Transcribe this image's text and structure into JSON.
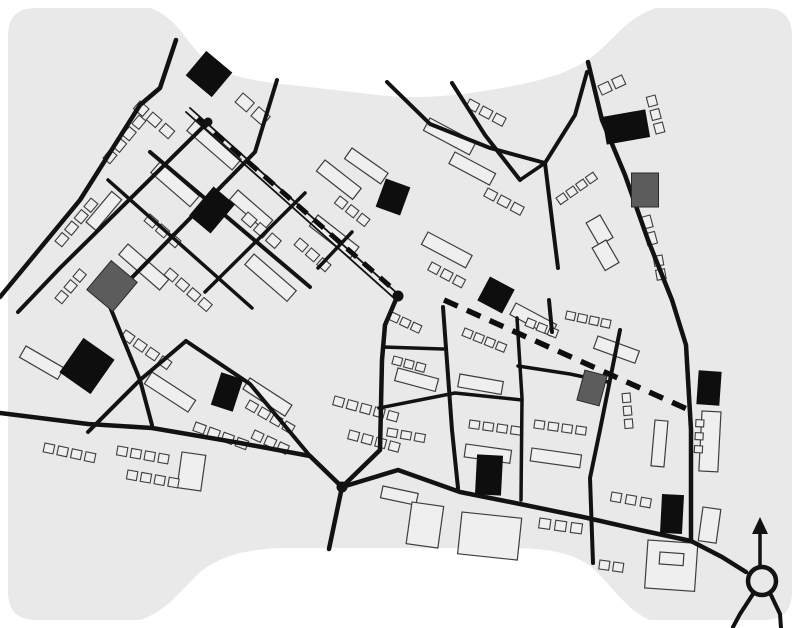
{
  "meta": {
    "figure_kind": "figure-ground urban plan map",
    "canvas": {
      "w": 800,
      "h": 628
    }
  },
  "palette": {
    "page_bg": "#ffffff",
    "map_bg": "#e9e9e9",
    "road": "#121212",
    "building_stroke": "#3d3d3d",
    "building_fill": "#efefef",
    "landmark_fill": "#0e0e0e",
    "gray_fill": "#5c5c5c",
    "route_dash": "#0e0e0e"
  },
  "map_shape": "M 35 8 L 150 8 C 175 16 185 40 205 60 C 225 78 262 82 300 86 L 378 95 C 420 100 462 95 502 88 C 534 82 562 76 586 61 C 612 44 624 18 656 8 L 764 8 Q 792 8 792 36 L 792 592 Q 792 620 764 620 L 650 620 C 630 612 616 592 597 572 C 577 552 548 549 516 548 L 282 548 C 248 549 216 556 196 576 C 179 593 165 612 140 620 L 36 620 Q 8 620 8 592 L 8 36 Q 8 8 35 8 Z",
  "roads": [
    {
      "name": "nw-boundary-road",
      "w": 4.5,
      "pts": [
        [
          0,
          297
        ],
        [
          80,
          200
        ],
        [
          140,
          105
        ],
        [
          160,
          88
        ],
        [
          176,
          40
        ]
      ]
    },
    {
      "name": "cross-street-c1",
      "w": 4.0,
      "pts": [
        [
          208,
          122
        ],
        [
          60,
          268
        ],
        [
          18,
          312
        ]
      ]
    },
    {
      "name": "cross-street-c2",
      "w": 4.0,
      "pts": [
        [
          277,
          80
        ],
        [
          255,
          152
        ],
        [
          108,
          302
        ],
        [
          140,
          380
        ],
        [
          152,
          425
        ]
      ]
    },
    {
      "name": "cross-street-c3",
      "w": 3.5,
      "pts": [
        [
          305,
          193
        ],
        [
          205,
          292
        ]
      ]
    },
    {
      "name": "cross-street-c4",
      "w": 3.5,
      "pts": [
        [
          352,
          232
        ],
        [
          318,
          268
        ]
      ]
    },
    {
      "name": "parallel-street-s1",
      "w": 4.0,
      "pts": [
        [
          150,
          152
        ],
        [
          310,
          287
        ]
      ]
    },
    {
      "name": "parallel-street-s2",
      "w": 3.5,
      "pts": [
        [
          108,
          180
        ],
        [
          252,
          308
        ]
      ]
    },
    {
      "name": "sw-branch-street",
      "w": 4.0,
      "pts": [
        [
          186,
          341
        ],
        [
          140,
          380
        ],
        [
          88,
          432
        ]
      ]
    },
    {
      "name": "sw-diagonal-street",
      "w": 4.0,
      "pts": [
        [
          186,
          341
        ],
        [
          250,
          384
        ],
        [
          310,
          456
        ]
      ]
    },
    {
      "name": "southern-road",
      "w": 4.5,
      "pts": [
        [
          0,
          413
        ],
        [
          88,
          424
        ],
        [
          152,
          428
        ],
        [
          240,
          443
        ],
        [
          310,
          456
        ],
        [
          342,
          487
        ],
        [
          398,
          470
        ],
        [
          460,
          492
        ],
        [
          520,
          504
        ],
        [
          583,
          517
        ],
        [
          640,
          530
        ],
        [
          691,
          541
        ],
        [
          722,
          557
        ],
        [
          746,
          572
        ]
      ]
    },
    {
      "name": "central-vertical-v1",
      "w": 4.5,
      "pts": [
        [
          397,
          297
        ],
        [
          385,
          325
        ],
        [
          382,
          360
        ],
        [
          380,
          450
        ],
        [
          342,
          487
        ],
        [
          329,
          549
        ]
      ]
    },
    {
      "name": "central-vertical-v2",
      "w": 4.0,
      "pts": [
        [
          443,
          307
        ],
        [
          452,
          430
        ],
        [
          458,
          488
        ]
      ]
    },
    {
      "name": "central-vertical-v3",
      "w": 3.5,
      "pts": [
        [
          517,
          318
        ],
        [
          522,
          398
        ],
        [
          521,
          500
        ]
      ]
    },
    {
      "name": "central-stub-v3b",
      "w": 4.0,
      "pts": [
        [
          549,
          300
        ],
        [
          552,
          332
        ]
      ]
    },
    {
      "name": "central-vertical-v4",
      "w": 4.0,
      "pts": [
        [
          620,
          330
        ],
        [
          600,
          430
        ],
        [
          590,
          478
        ],
        [
          593,
          563
        ]
      ]
    },
    {
      "name": "central-horizontal-h1",
      "w": 3.5,
      "pts": [
        [
          379,
          408
        ],
        [
          455,
          393
        ],
        [
          522,
          400
        ]
      ]
    },
    {
      "name": "central-horizontal-h2",
      "w": 3.5,
      "pts": [
        [
          383,
          347
        ],
        [
          443,
          349
        ]
      ]
    },
    {
      "name": "central-horizontal-h3",
      "w": 3.5,
      "pts": [
        [
          518,
          366
        ],
        [
          570,
          374
        ],
        [
          608,
          382
        ]
      ]
    },
    {
      "name": "north-street-t1",
      "w": 4.0,
      "pts": [
        [
          387,
          82
        ],
        [
          430,
          124
        ],
        [
          490,
          148
        ],
        [
          545,
          163
        ]
      ]
    },
    {
      "name": "north-street-t2",
      "w": 4.0,
      "pts": [
        [
          452,
          83
        ],
        [
          485,
          135
        ],
        [
          520,
          180
        ]
      ]
    },
    {
      "name": "north-street-t2b",
      "w": 3.5,
      "pts": [
        [
          520,
          180
        ],
        [
          545,
          163
        ]
      ]
    },
    {
      "name": "north-street-t4",
      "w": 4.0,
      "pts": [
        [
          545,
          163
        ],
        [
          552,
          220
        ],
        [
          558,
          268
        ]
      ]
    },
    {
      "name": "north-street-r2",
      "w": 4.0,
      "pts": [
        [
          545,
          163
        ],
        [
          575,
          115
        ],
        [
          587,
          72
        ]
      ]
    },
    {
      "name": "east-boundary-road",
      "w": 4.5,
      "pts": [
        [
          588,
          62
        ],
        [
          602,
          120
        ],
        [
          625,
          175
        ],
        [
          648,
          240
        ],
        [
          672,
          300
        ],
        [
          686,
          345
        ],
        [
          691,
          430
        ],
        [
          691,
          540
        ]
      ]
    }
  ],
  "avenue": {
    "name": "main-avenue-double-line",
    "w": 1.8,
    "lines": [
      [
        [
          186,
          112
        ],
        [
          395,
          299
        ]
      ],
      [
        [
          190,
          108
        ],
        [
          399,
          295
        ]
      ]
    ]
  },
  "routes": [
    {
      "name": "dashed-route-nw",
      "w": 5.0,
      "dash": "13 9",
      "pts": [
        [
          198,
          118
        ],
        [
          392,
          288
        ]
      ]
    },
    {
      "name": "dashed-route-east",
      "w": 5.5,
      "dash": "15 10",
      "pts": [
        [
          444,
          300
        ],
        [
          687,
          409
        ]
      ]
    }
  ],
  "junction_dots": [
    {
      "x": 208,
      "y": 122,
      "r": 4.5
    },
    {
      "x": 398,
      "y": 296,
      "r": 5.5
    },
    {
      "x": 342,
      "y": 487,
      "r": 5.5
    }
  ],
  "roundabout": {
    "cx": 762,
    "cy": 581,
    "r": 14,
    "ring_w": 4.5,
    "arrow_stem": [
      [
        760,
        566
      ],
      [
        760,
        532
      ]
    ],
    "arrow_head": "760,517 752,534 768,534",
    "legs": [
      [
        [
          753,
          594
        ],
        [
          740,
          614
        ],
        [
          733,
          627
        ]
      ],
      [
        [
          771,
          595
        ],
        [
          780,
          614
        ],
        [
          781,
          628
        ]
      ]
    ]
  },
  "landmark_buildings": [
    [
      209,
      74,
      34,
      32,
      40
    ],
    [
      393,
      197,
      26,
      30,
      20
    ],
    [
      212,
      210,
      28,
      38,
      40
    ],
    [
      626,
      127,
      44,
      28,
      -10
    ],
    [
      87,
      366,
      38,
      42,
      35
    ],
    [
      227,
      392,
      23,
      34,
      18
    ],
    [
      496,
      295,
      28,
      27,
      28
    ],
    [
      709,
      388,
      23,
      34,
      4
    ],
    [
      489,
      475,
      26,
      40,
      3
    ],
    [
      672,
      514,
      22,
      39,
      3
    ]
  ],
  "gray_buildings": [
    [
      112,
      286,
      34,
      38,
      40
    ],
    [
      645,
      190,
      27,
      34,
      0
    ],
    [
      592,
      388,
      23,
      31,
      15
    ]
  ],
  "building_slabs": [
    [
      196,
      120,
      60,
      14,
      41
    ],
    [
      160,
      162,
      52,
      14,
      41
    ],
    [
      238,
      190,
      46,
      13,
      41
    ],
    [
      128,
      244,
      54,
      14,
      41
    ],
    [
      86,
      222,
      40,
      13,
      -50
    ],
    [
      254,
      254,
      56,
      14,
      41
    ],
    [
      325,
      160,
      46,
      14,
      38
    ],
    [
      318,
      215,
      52,
      14,
      38
    ],
    [
      430,
      118,
      52,
      14,
      28
    ],
    [
      455,
      152,
      46,
      13,
      28
    ],
    [
      352,
      148,
      44,
      13,
      35
    ],
    [
      428,
      232,
      50,
      14,
      28
    ],
    [
      516,
      303,
      46,
      13,
      28
    ],
    [
      398,
      368,
      42,
      13,
      15
    ],
    [
      460,
      374,
      44,
      13,
      10
    ],
    [
      466,
      444,
      46,
      13,
      8
    ],
    [
      532,
      448,
      50,
      13,
      8
    ],
    [
      598,
      336,
      44,
      13,
      20
    ],
    [
      655,
      420,
      13,
      46,
      5
    ],
    [
      702,
      411,
      19,
      60,
      3
    ],
    [
      703,
      507,
      18,
      34,
      8
    ],
    [
      26,
      346,
      44,
      13,
      30
    ],
    [
      152,
      372,
      52,
      14,
      33
    ],
    [
      250,
      378,
      50,
      13,
      33
    ],
    [
      182,
      452,
      24,
      36,
      8
    ],
    [
      383,
      486,
      36,
      12,
      12
    ],
    [
      412,
      502,
      32,
      42,
      8
    ],
    [
      462,
      512,
      60,
      42,
      6
    ],
    [
      648,
      540,
      50,
      48,
      4
    ],
    [
      660,
      552,
      24,
      12,
      4
    ],
    [
      600,
      215,
      26,
      16,
      60
    ],
    [
      606,
      240,
      26,
      16,
      60
    ]
  ],
  "building_rows": [
    [
      140,
      101,
      3,
      12,
      10,
      5,
      41
    ],
    [
      243,
      93,
      2,
      15,
      12,
      6,
      41
    ],
    [
      103,
      158,
      4,
      11,
      9,
      4,
      -50
    ],
    [
      55,
      241,
      4,
      11,
      9,
      4,
      -50
    ],
    [
      55,
      298,
      3,
      10,
      9,
      4,
      -50
    ],
    [
      248,
      212,
      3,
      12,
      10,
      4,
      41
    ],
    [
      150,
      214,
      3,
      11,
      9,
      4,
      41
    ],
    [
      170,
      268,
      4,
      11,
      9,
      4,
      41
    ],
    [
      300,
      238,
      3,
      11,
      9,
      4,
      41
    ],
    [
      340,
      196,
      3,
      10,
      9,
      4,
      38
    ],
    [
      470,
      99,
      3,
      11,
      9,
      4,
      28
    ],
    [
      488,
      188,
      3,
      11,
      9,
      4,
      28
    ],
    [
      598,
      86,
      2,
      11,
      10,
      4,
      -25
    ],
    [
      556,
      198,
      4,
      9,
      8,
      3,
      -35
    ],
    [
      567,
      311,
      4,
      9,
      8,
      3,
      12
    ],
    [
      432,
      262,
      3,
      10,
      9,
      4,
      28
    ],
    [
      392,
      312,
      3,
      9,
      8,
      3,
      25
    ],
    [
      394,
      356,
      3,
      9,
      8,
      3,
      15
    ],
    [
      465,
      328,
      4,
      9,
      8,
      3,
      22
    ],
    [
      528,
      318,
      3,
      9,
      8,
      3,
      22
    ],
    [
      388,
      428,
      3,
      10,
      8,
      4,
      10
    ],
    [
      470,
      420,
      4,
      10,
      8,
      4,
      8
    ],
    [
      535,
      420,
      4,
      10,
      8,
      4,
      8
    ],
    [
      655,
      95,
      3,
      10,
      9,
      4,
      75
    ],
    [
      650,
      215,
      2,
      12,
      10,
      5,
      75
    ],
    [
      662,
      255,
      2,
      10,
      9,
      4,
      80
    ],
    [
      630,
      393,
      3,
      9,
      8,
      4,
      85
    ],
    [
      704,
      420,
      3,
      7,
      8,
      6,
      93
    ],
    [
      45,
      443,
      4,
      10,
      9,
      4,
      12
    ],
    [
      118,
      446,
      4,
      10,
      9,
      4,
      10
    ],
    [
      128,
      470,
      4,
      10,
      9,
      4,
      10
    ],
    [
      196,
      422,
      4,
      11,
      9,
      4,
      20
    ],
    [
      126,
      330,
      4,
      11,
      9,
      4,
      35
    ],
    [
      250,
      400,
      4,
      10,
      9,
      4,
      30
    ],
    [
      255,
      430,
      3,
      10,
      9,
      4,
      25
    ],
    [
      335,
      396,
      5,
      10,
      9,
      4,
      15
    ],
    [
      350,
      430,
      4,
      10,
      9,
      4,
      15
    ],
    [
      540,
      518,
      3,
      11,
      10,
      5,
      8
    ],
    [
      612,
      492,
      3,
      10,
      9,
      5,
      10
    ],
    [
      600,
      560,
      2,
      10,
      9,
      4,
      8
    ]
  ]
}
